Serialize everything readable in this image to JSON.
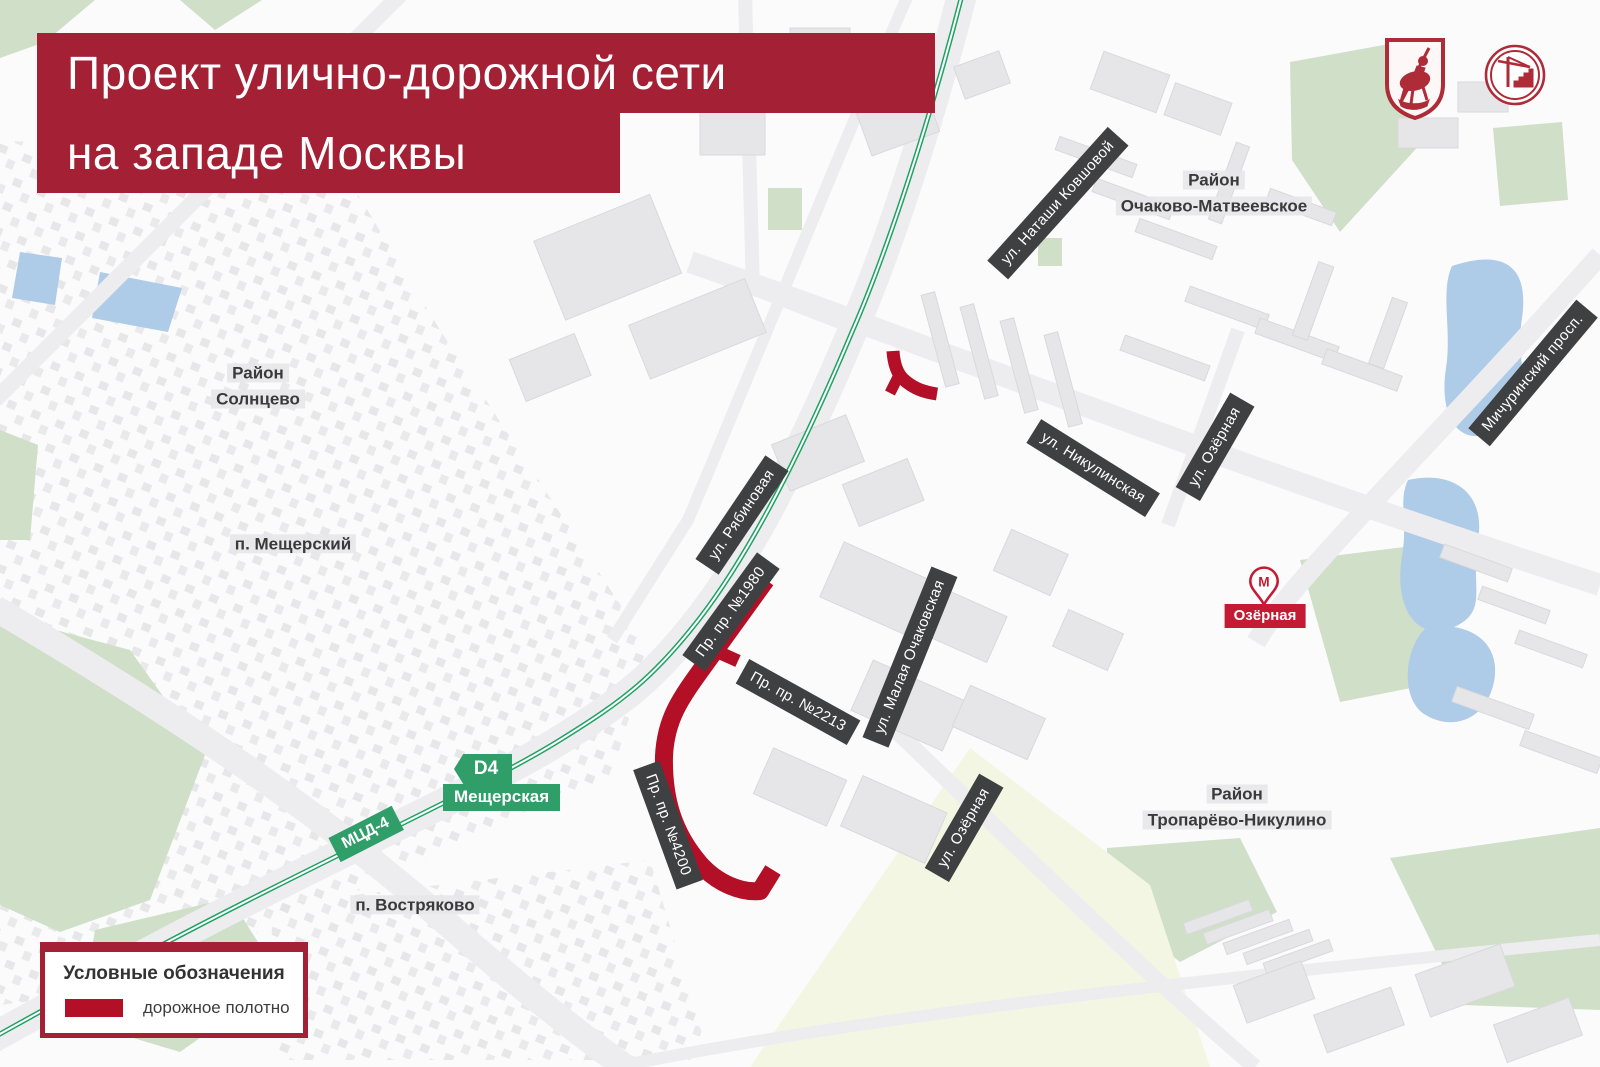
{
  "title": {
    "line1": "Проект улично-дорожной сети",
    "line2": "на западе Москвы"
  },
  "icons": {
    "logo_left": "moscow-coat-of-arms-icon",
    "logo_right": "construction-complex-icon",
    "metro_pin": "metro-station-icon"
  },
  "districts": [
    {
      "line1": "Район",
      "line2": "Солнцево"
    },
    {
      "line1": "п. Мещерский",
      "line2": ""
    },
    {
      "line1": "Район",
      "line2": "Очаково-Матвеевское"
    },
    {
      "line1": "Район",
      "line2": "Тропарёво-Никулино"
    },
    {
      "line1": "п. Востряково",
      "line2": ""
    }
  ],
  "streets": [
    {
      "name": "ул. Наташи Ковшовой"
    },
    {
      "name": "ул. Никулинская"
    },
    {
      "name": "ул. Озёрная"
    },
    {
      "name": "Мичуринский просп."
    },
    {
      "name": "ул. Рябиновая"
    },
    {
      "name": "Пр. пр. №1980"
    },
    {
      "name": "Пр. пр. №2213"
    },
    {
      "name": "ул. Малая Очаковская"
    },
    {
      "name": "Пр. пр. №4200"
    },
    {
      "name": "ул. Озёрная"
    }
  ],
  "transit": {
    "mcd_line_badge": "МЦД-4",
    "d4_badge": "D4",
    "station": "Мещерская",
    "metro_station": "Озёрная",
    "metro_letter": "М"
  },
  "legend": {
    "title": "Условные обозначения",
    "items": [
      {
        "label": "дорожное полотно",
        "swatch_color": "#b30f27"
      }
    ]
  },
  "colors": {
    "banner_red": "#a32035",
    "project_road_red": "#b30f27",
    "street_badge_dark": "#3e4042",
    "railway_green": "#1ea263",
    "mcd_badge_green": "#2f9e69",
    "metro_red": "#c51a33",
    "water_blue": "#aecbe8",
    "park_green": "#cfdfc8",
    "field_beige": "#f4f6e4"
  }
}
